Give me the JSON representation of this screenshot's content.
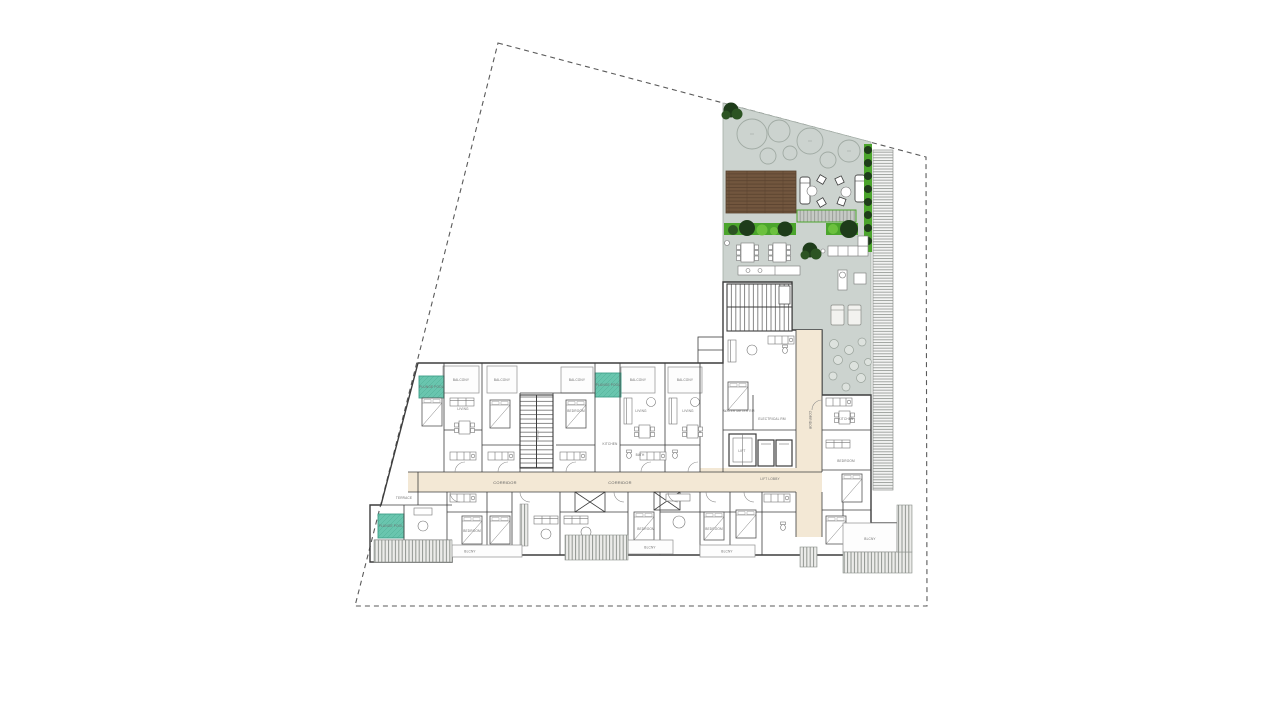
{
  "document": {
    "drawing_type": "architectural floor plan / roof level site plan",
    "background": "white paper, no title block visible"
  },
  "colors": {
    "paper": "#ffffff",
    "boundary_line": "#5a5a5a",
    "wall_line": "#3d3d3d",
    "furniture_line": "#777777",
    "terrace_fill": "#ccd3cf",
    "terrace_line": "#a3ada6",
    "deck_brown": "#72563e",
    "deck_line": "#57412d",
    "slat_fill": "#c6cac5",
    "hedge_green": "#4ba52c",
    "hedge_dark": "#1e3c1a",
    "tree_ring": "#a7b0a9",
    "pool_teal": "#69c5ae",
    "pool_line": "#3f9f89",
    "corridor_cream": "#f3e8d5",
    "hatch_gray": "#8f948f"
  },
  "labels": {
    "balcony": "BALCONY",
    "balcony_short": "BLCNY",
    "plunge_pool": "PLUNGE POOL",
    "corridor": "CORRIDOR",
    "lift_lobby": "LIFT LOBBY",
    "lift": "LIFT",
    "stair": "STAIR",
    "terrace": "TERRACE",
    "bedroom": "BEDROOM",
    "living": "LIVING",
    "kitchen": "KITCHEN",
    "bath": "BATH",
    "water_meter_room": "WATER METER RM",
    "electrical_room": "ELECTRICAL RM"
  },
  "site": {
    "boundary_polygon_px": [
      [
        498,
        43
      ],
      [
        926,
        157
      ],
      [
        927,
        606
      ],
      [
        355,
        606
      ]
    ],
    "boundary_style": "dashed survey line"
  },
  "roof_terrace": {
    "tree_canopy_circles": 7,
    "timber_deck": true,
    "slatted_step_strip": true,
    "hedge_rows": 3,
    "dining_sets": 2,
    "lounge_sofa_set": true,
    "sun_loungers": 2,
    "chaise_lounges": 2,
    "stepping_stones": 9,
    "louver_screen_east_edge": true
  },
  "building": {
    "shape": "L-shaped apartment floor plate",
    "plunge_pools": 3,
    "stair_cores": 2,
    "lifts": 3,
    "service_shafts": 2,
    "top_row_balconies": 5,
    "bottom_balconies": 4
  }
}
